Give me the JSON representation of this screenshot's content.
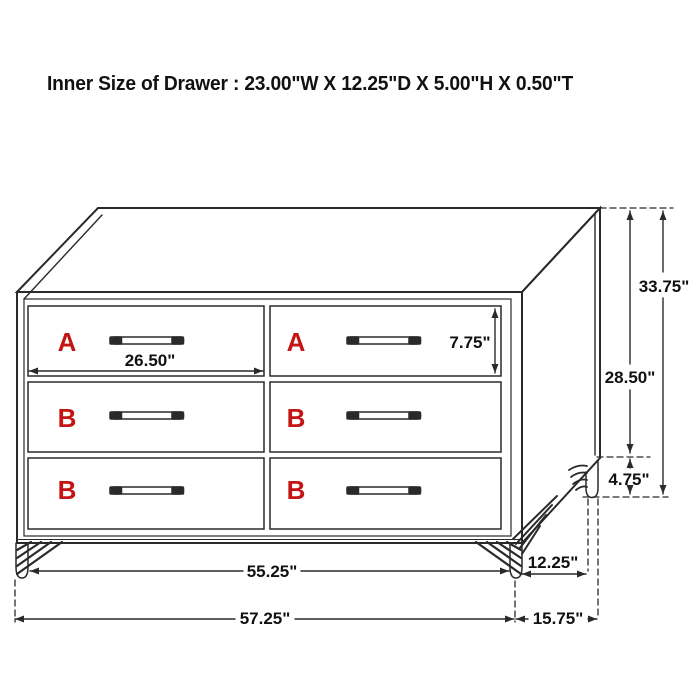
{
  "title": "Inner Size of Drawer : 23.00\"W X 12.25\"D X 5.00\"H X 0.50\"T",
  "colors": {
    "line": "#2a2a2a",
    "dimension_text": "#111111",
    "drawer_letter_red": "#c41414",
    "background": "#ffffff"
  },
  "drawers": {
    "rows": [
      {
        "left_label": "A",
        "right_label": "A"
      },
      {
        "left_label": "B",
        "right_label": "B"
      },
      {
        "left_label": "B",
        "right_label": "B"
      }
    ]
  },
  "dimensions": {
    "drawer_width": "26.50\"",
    "drawer_face_height": "7.75\"",
    "overall_height": "33.75\"",
    "body_height": "28.50\"",
    "leg_height": "4.75\"",
    "front_leg_span": "55.25\"",
    "side_leg_span": "12.25\"",
    "overall_width": "57.25\"",
    "overall_depth": "15.75\""
  }
}
